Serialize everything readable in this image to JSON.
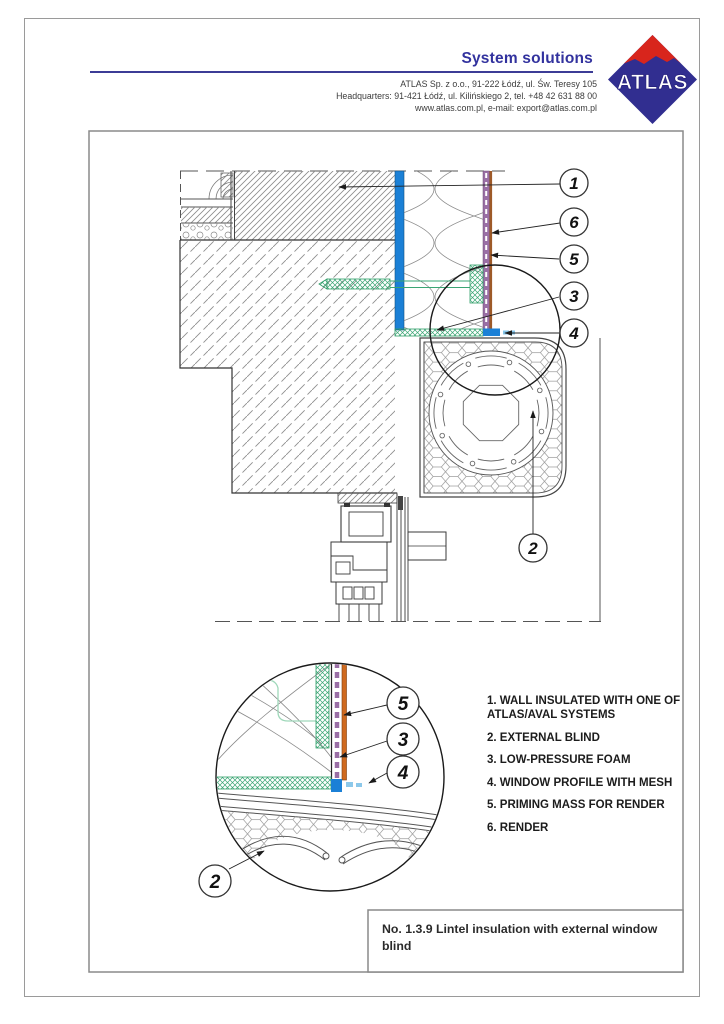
{
  "header": {
    "title": "System solutions",
    "address_lines": [
      "ATLAS Sp. z o.o.,  91-222 Łódź, ul. Św. Teresy 105",
      "Headquarters: 91-421 Łódź, ul. Kilińskiego 2,  tel. +48 42 631 88 00",
      "www.atlas.com.pl,   e-mail: export@atlas.com.pl"
    ],
    "logo_text": "ATLAS"
  },
  "legend": {
    "items": [
      "1. WALL INSULATED WITH ONE OF ATLAS/AVAL SYSTEMS",
      "2. EXTERNAL BLIND",
      "3. LOW-PRESSURE FOAM",
      "4. WINDOW PROFILE WITH MESH",
      "5. PRIMING MASS FOR RENDER",
      "6. RENDER"
    ]
  },
  "title_block": {
    "text": "No. 1.3.9 Lintel insulation with external window blind"
  },
  "callouts": {
    "c1": "1",
    "c2": "2",
    "c3": "3",
    "c4": "4",
    "c5": "5",
    "c6": "6"
  },
  "colors": {
    "adhesive_blue": "#1b80d6",
    "priming_purple": "#9a6fa5",
    "render_brown": "#9e5a28",
    "render_orange": "#cf6a1f",
    "anchor_green": "#3aa574",
    "brand_navy": "#312e90",
    "brand_red": "#d8251c"
  }
}
